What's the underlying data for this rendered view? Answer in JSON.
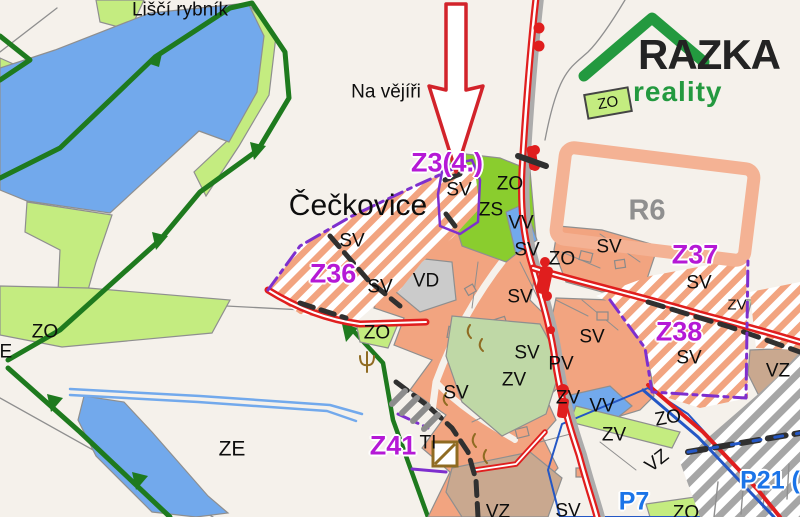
{
  "logo": {
    "brand": "RAZKA",
    "sub": "reality"
  },
  "colors": {
    "bg": "#F5F1EB",
    "water": "#72A9EC",
    "lgreen": "#C4EC80",
    "bgreen": "#8ACD2E",
    "dgreen": "#1E7A1E",
    "sage": "#BFD8A6",
    "salmon": "#F2A480",
    "salmon-lt": "#F4B294",
    "gray-area": "#CBCBCB",
    "tan": "#C9A88F",
    "red": "#E01E1E",
    "magenta": "#B519D6",
    "blue-label": "#1B74E8",
    "purple": "#7E2FCE",
    "dash-dark": "#303030",
    "blue-line": "#2457C5",
    "gray-road": "#ACACAC",
    "gray-line": "#8F8F8F",
    "brown": "#8F6B22",
    "gray-stripe": "#A6A6A6",
    "cross": "#35200C",
    "logo-green": "#23993F",
    "logo-dark": "#232323",
    "label-dark": "#0D0D0D"
  },
  "map_labels": [
    {
      "name": "lisci-rybnik",
      "text": "Liščí rybník",
      "x": 180,
      "y": 10,
      "style": "place"
    },
    {
      "name": "na-vejiri",
      "text": "Na vějíři",
      "x": 386,
      "y": 92,
      "style": "place"
    },
    {
      "name": "ceckovice",
      "text": "Čečkovice",
      "x": 358,
      "y": 206,
      "style": "town"
    },
    {
      "name": "zone-z3",
      "text": "Z3(4.)",
      "x": 447,
      "y": 163,
      "style": "zone-m"
    },
    {
      "name": "sv-1",
      "text": "SV",
      "x": 459,
      "y": 190,
      "style": "area"
    },
    {
      "name": "zo-1",
      "text": "ZO",
      "x": 510,
      "y": 184,
      "style": "area"
    },
    {
      "name": "zs-1",
      "text": "ZS",
      "x": 491,
      "y": 210,
      "style": "area"
    },
    {
      "name": "vv-1",
      "text": "VV",
      "x": 521,
      "y": 223,
      "style": "area"
    },
    {
      "name": "sv-2",
      "text": "SV",
      "x": 352,
      "y": 241,
      "style": "area"
    },
    {
      "name": "zone-z36",
      "text": "Z36",
      "x": 333,
      "y": 274,
      "style": "zone-m"
    },
    {
      "name": "sv-3",
      "text": "SV",
      "x": 380,
      "y": 287,
      "style": "area"
    },
    {
      "name": "vd-1",
      "text": "VD",
      "x": 426,
      "y": 281,
      "style": "area"
    },
    {
      "name": "sv-4",
      "text": "SV",
      "x": 527,
      "y": 250,
      "style": "area"
    },
    {
      "name": "zo-2",
      "text": "ZO",
      "x": 562,
      "y": 259,
      "style": "area"
    },
    {
      "name": "sv-5",
      "text": "SV",
      "x": 609,
      "y": 247,
      "style": "area"
    },
    {
      "name": "zone-r6",
      "text": "R6",
      "x": 647,
      "y": 211,
      "style": "zone-g"
    },
    {
      "name": "zone-z37",
      "text": "Z37",
      "x": 695,
      "y": 255,
      "style": "zone-m"
    },
    {
      "name": "sv-6",
      "text": "SV",
      "x": 699,
      "y": 283,
      "style": "area"
    },
    {
      "name": "sv-7",
      "text": "SV",
      "x": 520,
      "y": 297,
      "style": "area"
    },
    {
      "name": "sv-8",
      "text": "SV",
      "x": 592,
      "y": 337,
      "style": "area"
    },
    {
      "name": "sv-9",
      "text": "SV",
      "x": 527,
      "y": 353,
      "style": "area"
    },
    {
      "name": "pv-1",
      "text": "PV",
      "x": 561,
      "y": 364,
      "style": "area"
    },
    {
      "name": "zv-1",
      "text": "ZV",
      "x": 514,
      "y": 380,
      "style": "area"
    },
    {
      "name": "zv-2",
      "text": "ZV",
      "x": 568,
      "y": 398,
      "style": "area"
    },
    {
      "name": "vv-2",
      "text": "VV",
      "x": 602,
      "y": 406,
      "style": "area"
    },
    {
      "name": "zone-z38",
      "text": "Z38",
      "x": 679,
      "y": 332,
      "style": "zone-m"
    },
    {
      "name": "sv-10",
      "text": "SV",
      "x": 689,
      "y": 358,
      "style": "area"
    },
    {
      "name": "vz-1",
      "text": "VZ",
      "x": 778,
      "y": 371,
      "style": "area"
    },
    {
      "name": "zv-3",
      "text": "ZV",
      "x": 737,
      "y": 305,
      "style": "area-sm"
    },
    {
      "name": "zv-4",
      "text": "ZV",
      "x": 614,
      "y": 435,
      "style": "area"
    },
    {
      "name": "zo-3",
      "text": "ZO",
      "x": 668,
      "y": 418,
      "style": "area",
      "rot": -10
    },
    {
      "name": "vz-2",
      "text": "VZ",
      "x": 657,
      "y": 461,
      "style": "area",
      "rot": -38
    },
    {
      "name": "zo-4",
      "text": "ZO",
      "x": 45,
      "y": 332,
      "style": "area"
    },
    {
      "name": "ze-1",
      "text": "ZE",
      "x": 0,
      "y": 352,
      "style": "area"
    },
    {
      "name": "ze-2",
      "text": "ZE",
      "x": 232,
      "y": 449,
      "style": "area-lg"
    },
    {
      "name": "zo-5",
      "text": "ZO",
      "x": 377,
      "y": 333,
      "style": "area"
    },
    {
      "name": "sv-11",
      "text": "SV",
      "x": 456,
      "y": 393,
      "style": "area"
    },
    {
      "name": "zone-z41",
      "text": "Z41",
      "x": 393,
      "y": 446,
      "style": "zone-m"
    },
    {
      "name": "ti-1",
      "text": "TI",
      "x": 428,
      "y": 443,
      "style": "area"
    },
    {
      "name": "vz-3",
      "text": "VZ",
      "x": 498,
      "y": 512,
      "style": "area"
    },
    {
      "name": "sv-12",
      "text": "SV",
      "x": 568,
      "y": 511,
      "style": "area"
    },
    {
      "name": "zone-p7",
      "text": "P7",
      "x": 634,
      "y": 502,
      "style": "zone-b"
    },
    {
      "name": "zone-p21",
      "text": "P21 (",
      "x": 770,
      "y": 481,
      "style": "zone-b"
    },
    {
      "name": "zo-6",
      "text": "ZO",
      "x": 686,
      "y": 513,
      "style": "area"
    },
    {
      "name": "zo-logo",
      "text": "ZO",
      "x": 608,
      "y": 103,
      "style": "area-sm",
      "rot": -10
    }
  ]
}
